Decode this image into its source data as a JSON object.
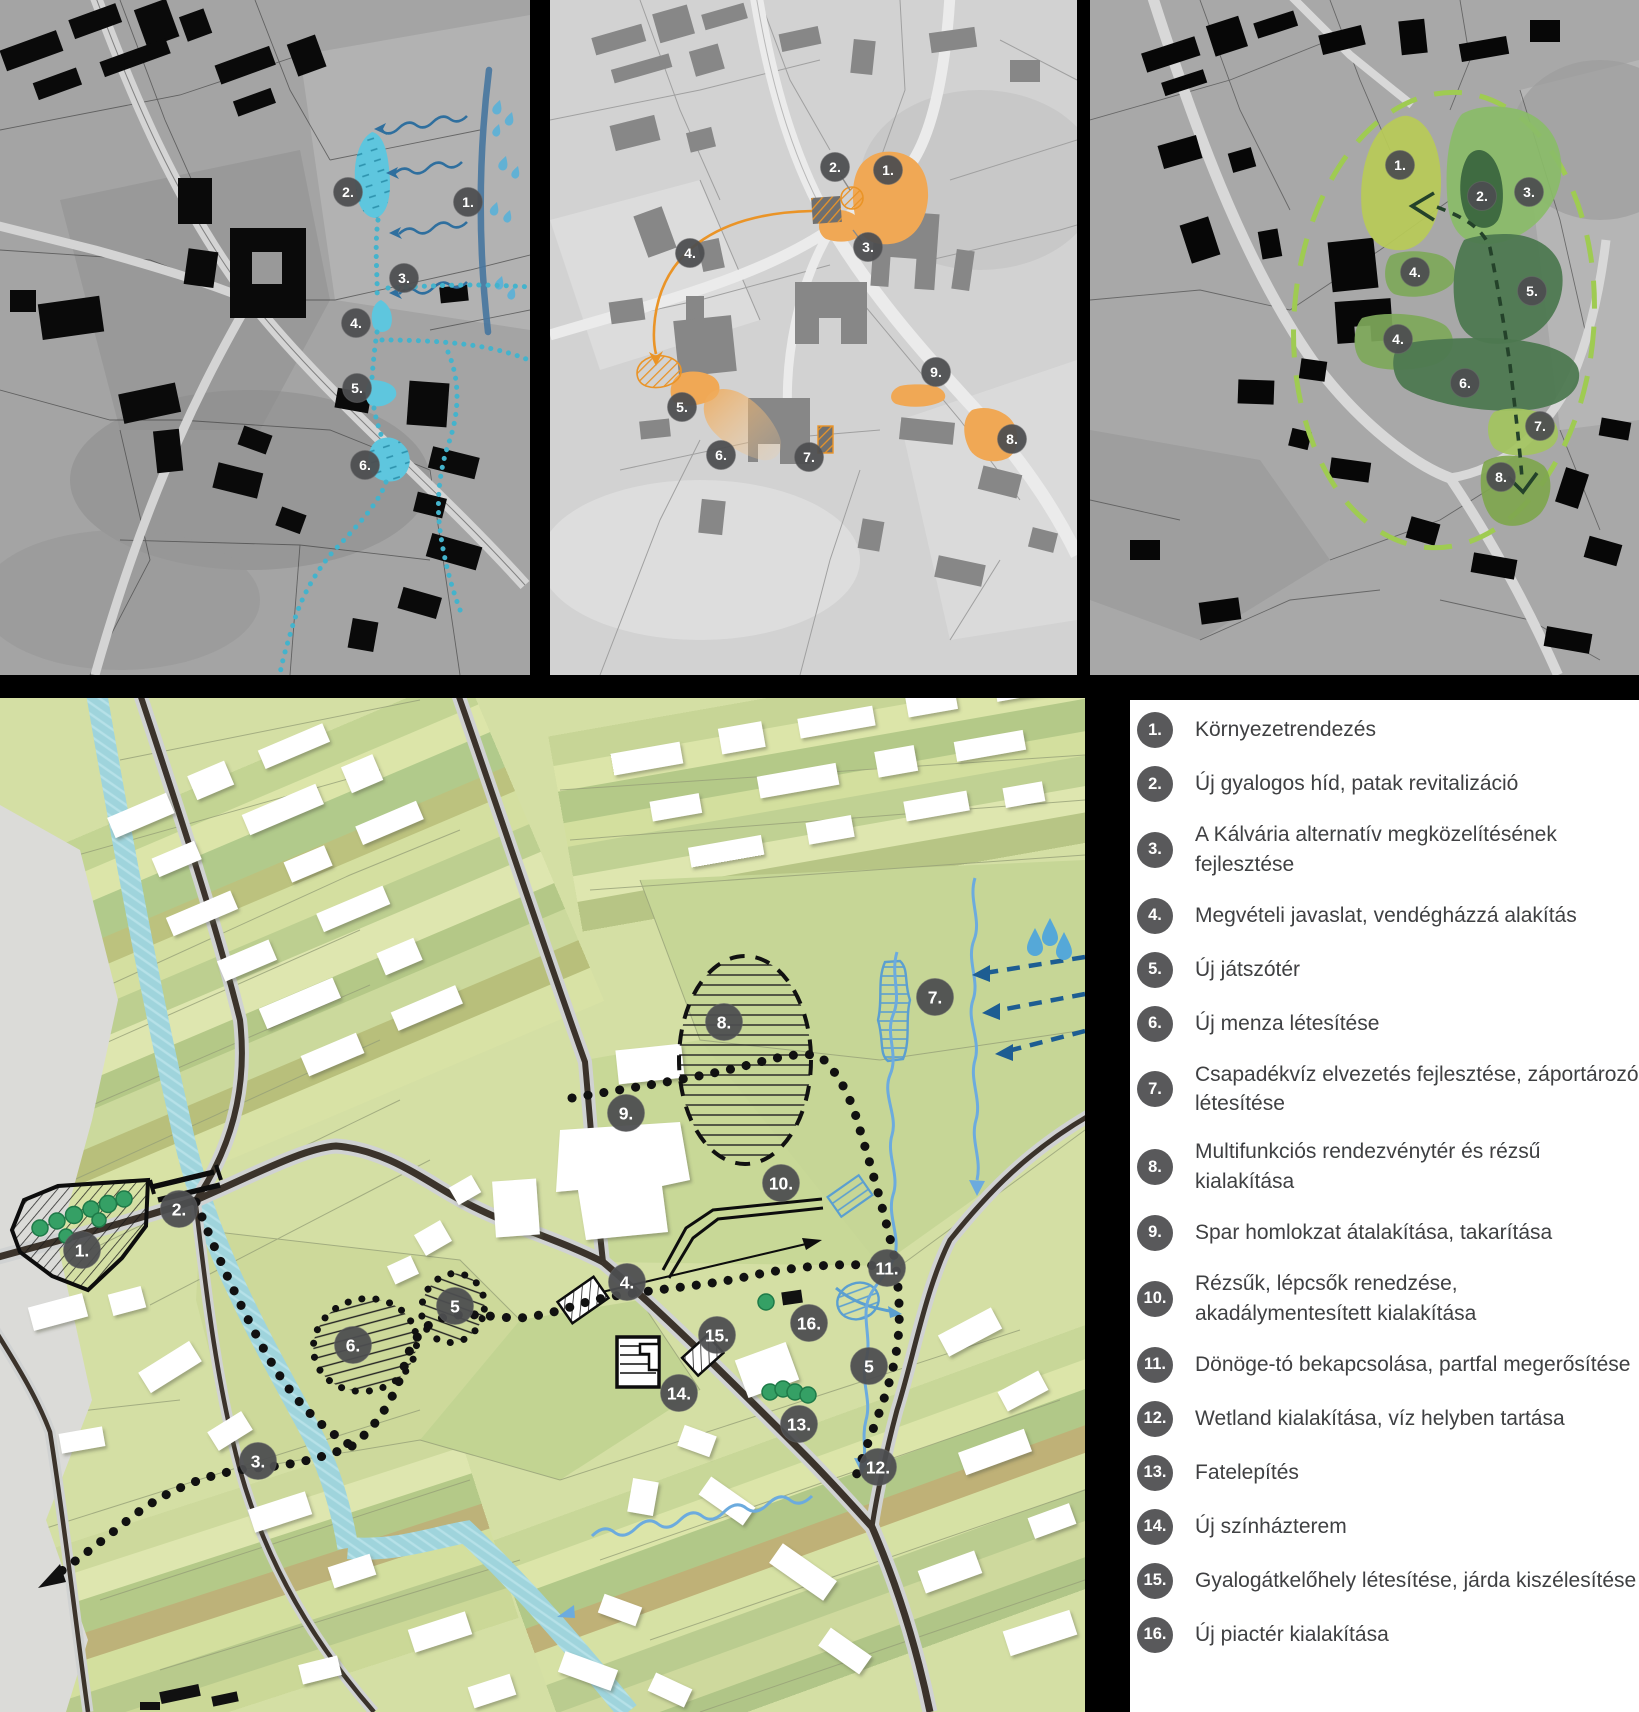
{
  "legend": {
    "items": [
      {
        "num": "1.",
        "label": "Környezetrendezés"
      },
      {
        "num": "2.",
        "label": "Új gyalogos híd, patak revitalizáció"
      },
      {
        "num": "3.",
        "label": "A Kálvária alternatív megközelítésének fejlesztése"
      },
      {
        "num": "4.",
        "label": "Megvételi javaslat, vendégházzá alakítás"
      },
      {
        "num": "5.",
        "label": "Új játszótér"
      },
      {
        "num": "6.",
        "label": "Új menza létesítése"
      },
      {
        "num": "7.",
        "label": "Csapadékvíz elvezetés fejlesztése, záportározó létesítése"
      },
      {
        "num": "8.",
        "label": "Multifunkciós rendezvénytér és rézsű kialakítása"
      },
      {
        "num": "9.",
        "label": "Spar homlokzat átalakítása, takarítása"
      },
      {
        "num": "10.",
        "label": "Rézsűk, lépcsők renedzése, akadálymentesített  kialakítása"
      },
      {
        "num": "11.",
        "label": "Dönöge-tó bekapcsolása, partfal megerősítése"
      },
      {
        "num": "12.",
        "label": "Wetland kialakítása, víz helyben tartása"
      },
      {
        "num": "13.",
        "label": "Fatelepítés"
      },
      {
        "num": "14.",
        "label": "Új színházterem"
      },
      {
        "num": "15.",
        "label": "Gyalogátkelőhely létesítése, járda kiszélesítése"
      },
      {
        "num": "16.",
        "label": "Új piactér kialakítása"
      }
    ]
  },
  "panels": {
    "water": {
      "markers": [
        {
          "n": "1.",
          "x": 468,
          "y": 202
        },
        {
          "n": "2.",
          "x": 348,
          "y": 192
        },
        {
          "n": "3.",
          "x": 404,
          "y": 278
        },
        {
          "n": "4.",
          "x": 356,
          "y": 323
        },
        {
          "n": "5.",
          "x": 357,
          "y": 388
        },
        {
          "n": "6.",
          "x": 365,
          "y": 465
        }
      ]
    },
    "orange": {
      "markers": [
        {
          "n": "1.",
          "x": 888,
          "y": 170
        },
        {
          "n": "2.",
          "x": 835,
          "y": 167
        },
        {
          "n": "3.",
          "x": 868,
          "y": 247
        },
        {
          "n": "4.",
          "x": 690,
          "y": 253
        },
        {
          "n": "5.",
          "x": 682,
          "y": 407
        },
        {
          "n": "6.",
          "x": 721,
          "y": 455
        },
        {
          "n": "7.",
          "x": 809,
          "y": 457
        },
        {
          "n": "8.",
          "x": 1012,
          "y": 439
        },
        {
          "n": "9.",
          "x": 936,
          "y": 372
        }
      ]
    },
    "green": {
      "markers": [
        {
          "n": "1.",
          "x": 1400,
          "y": 165
        },
        {
          "n": "2.",
          "x": 1482,
          "y": 196
        },
        {
          "n": "3.",
          "x": 1529,
          "y": 192
        },
        {
          "n": "4.",
          "x": 1415,
          "y": 272
        },
        {
          "n": "5.",
          "x": 1532,
          "y": 291
        },
        {
          "n": "4.",
          "x": 1398,
          "y": 339
        },
        {
          "n": "6.",
          "x": 1465,
          "y": 383
        },
        {
          "n": "7.",
          "x": 1540,
          "y": 426
        },
        {
          "n": "8.",
          "x": 1501,
          "y": 477
        }
      ]
    }
  },
  "masterplan": {
    "markers": [
      {
        "n": "1.",
        "x": 82,
        "y": 1250
      },
      {
        "n": "2.",
        "x": 179,
        "y": 1209
      },
      {
        "n": "3.",
        "x": 258,
        "y": 1461
      },
      {
        "n": "4.",
        "x": 627,
        "y": 1282
      },
      {
        "n": "5",
        "x": 455,
        "y": 1306
      },
      {
        "n": "5",
        "x": 869,
        "y": 1366
      },
      {
        "n": "6.",
        "x": 353,
        "y": 1345
      },
      {
        "n": "7.",
        "x": 935,
        "y": 997
      },
      {
        "n": "8.",
        "x": 724,
        "y": 1022
      },
      {
        "n": "9.",
        "x": 626,
        "y": 1113
      },
      {
        "n": "10.",
        "x": 781,
        "y": 1183
      },
      {
        "n": "11.",
        "x": 887,
        "y": 1268
      },
      {
        "n": "12.",
        "x": 878,
        "y": 1467
      },
      {
        "n": "13.",
        "x": 799,
        "y": 1424
      },
      {
        "n": "14.",
        "x": 679,
        "y": 1393
      },
      {
        "n": "15.",
        "x": 717,
        "y": 1335
      },
      {
        "n": "16.",
        "x": 809,
        "y": 1323
      }
    ]
  },
  "colors": {
    "water_overlay": "#5ec6de",
    "water_line": "#46759e",
    "orange_overlay": "#f0a855",
    "green_light": "#b8ca57",
    "green_mid": "#8abc68",
    "green_dark": "#4c7850",
    "legend_circle": "#59595b",
    "legend_text": "#3f4042",
    "stream": "#9fd4dc",
    "navy": "#1d5d92"
  }
}
